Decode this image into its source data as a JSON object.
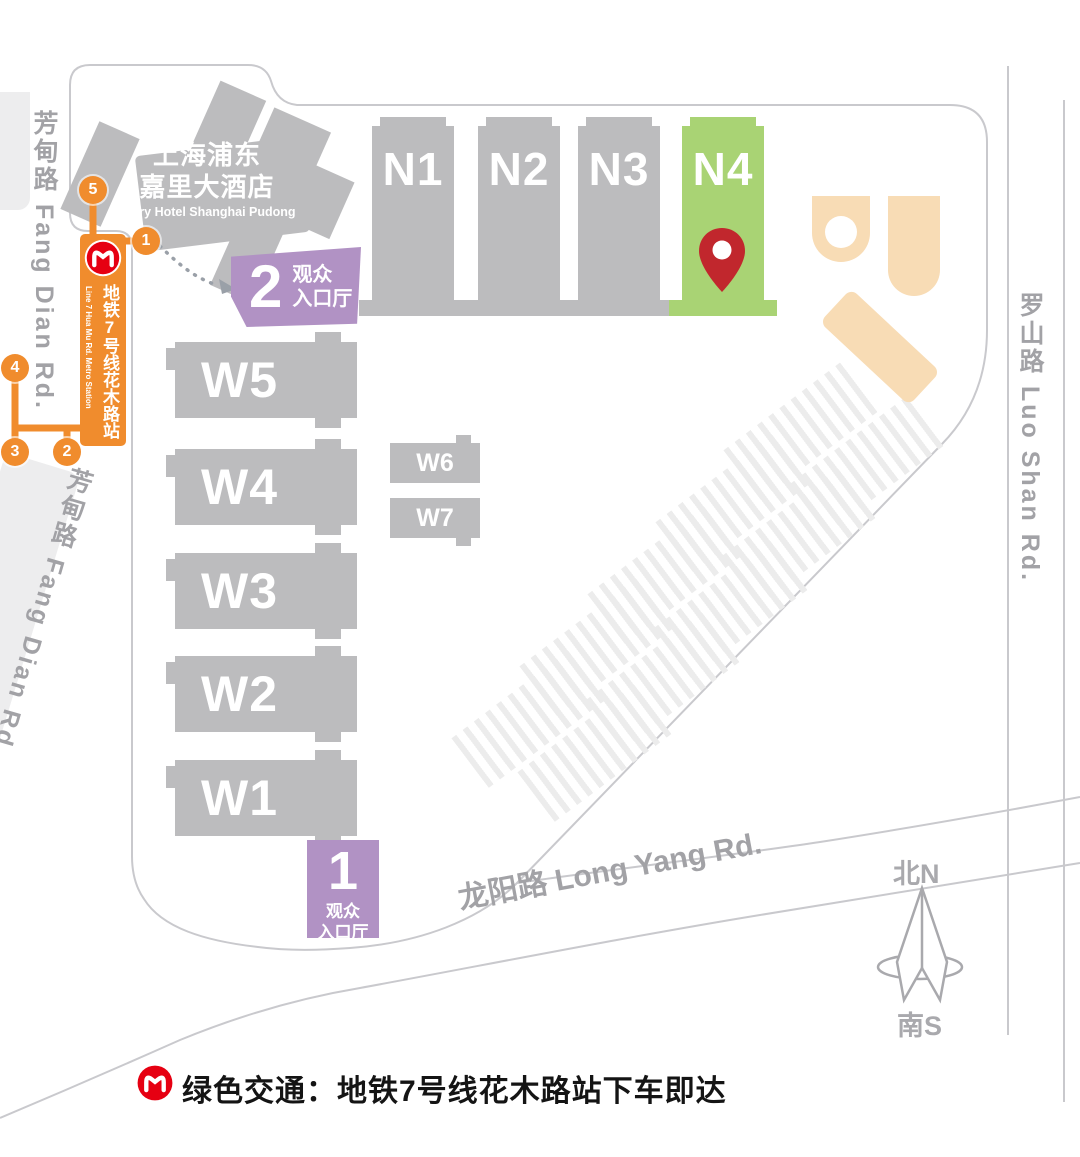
{
  "roads": {
    "fang_dian_top": "芳甸路 Fang Dian Rd.",
    "fang_dian_bottom": "芳甸路 Fang Dian Rd.",
    "luo_shan": "罗山路 Luo Shan Rd.",
    "long_yang": "龙阳路 Long Yang Rd."
  },
  "hotel": {
    "line1": "上海浦东",
    "line2": "嘉里大酒店",
    "line3": "Kerry Hotel Shanghai Pudong"
  },
  "halls": {
    "n": [
      {
        "label": "N1"
      },
      {
        "label": "N2"
      },
      {
        "label": "N3"
      },
      {
        "label": "N4",
        "highlighted": true
      }
    ],
    "w": [
      {
        "label": "W5"
      },
      {
        "label": "W4"
      },
      {
        "label": "W3"
      },
      {
        "label": "W2"
      },
      {
        "label": "W1"
      }
    ],
    "w_small": [
      {
        "label": "W6"
      },
      {
        "label": "W7"
      }
    ]
  },
  "entrances": {
    "hall2": {
      "number": "2",
      "line1": "观众",
      "line2": "入口厅"
    },
    "hall1": {
      "number": "1",
      "line1": "观众",
      "line2": "入口厅"
    }
  },
  "metro": {
    "station_cn": "地铁7号线花木路站",
    "station_en": "Line 7 Hua Mu Rd. Metro Station",
    "exits": {
      "e1": "1",
      "e2": "2",
      "e3": "3",
      "e4": "4",
      "e5": "5"
    }
  },
  "compass": {
    "north": "北N",
    "south": "南S"
  },
  "footer": {
    "note": "绿色交通：地铁7号线花木路站下车即达"
  },
  "icons": {
    "metro_logo": "shanghai-metro-logo",
    "destination_pin": "location-pin-icon",
    "compass": "compass-rose-icon",
    "route_arrow": "dashed-walking-route-arrow"
  },
  "colors": {
    "hall_gray": "#bcbcbe",
    "highlight_green": "#a9d374",
    "entrance_purple": "#b192c4",
    "metro_orange": "#f08c2d",
    "building_peach": "#f8dcb5",
    "pin_red": "#c1272d",
    "logo_red": "#e60012",
    "road_line": "#c9c9cd",
    "road_text": "#a2a2a6"
  }
}
